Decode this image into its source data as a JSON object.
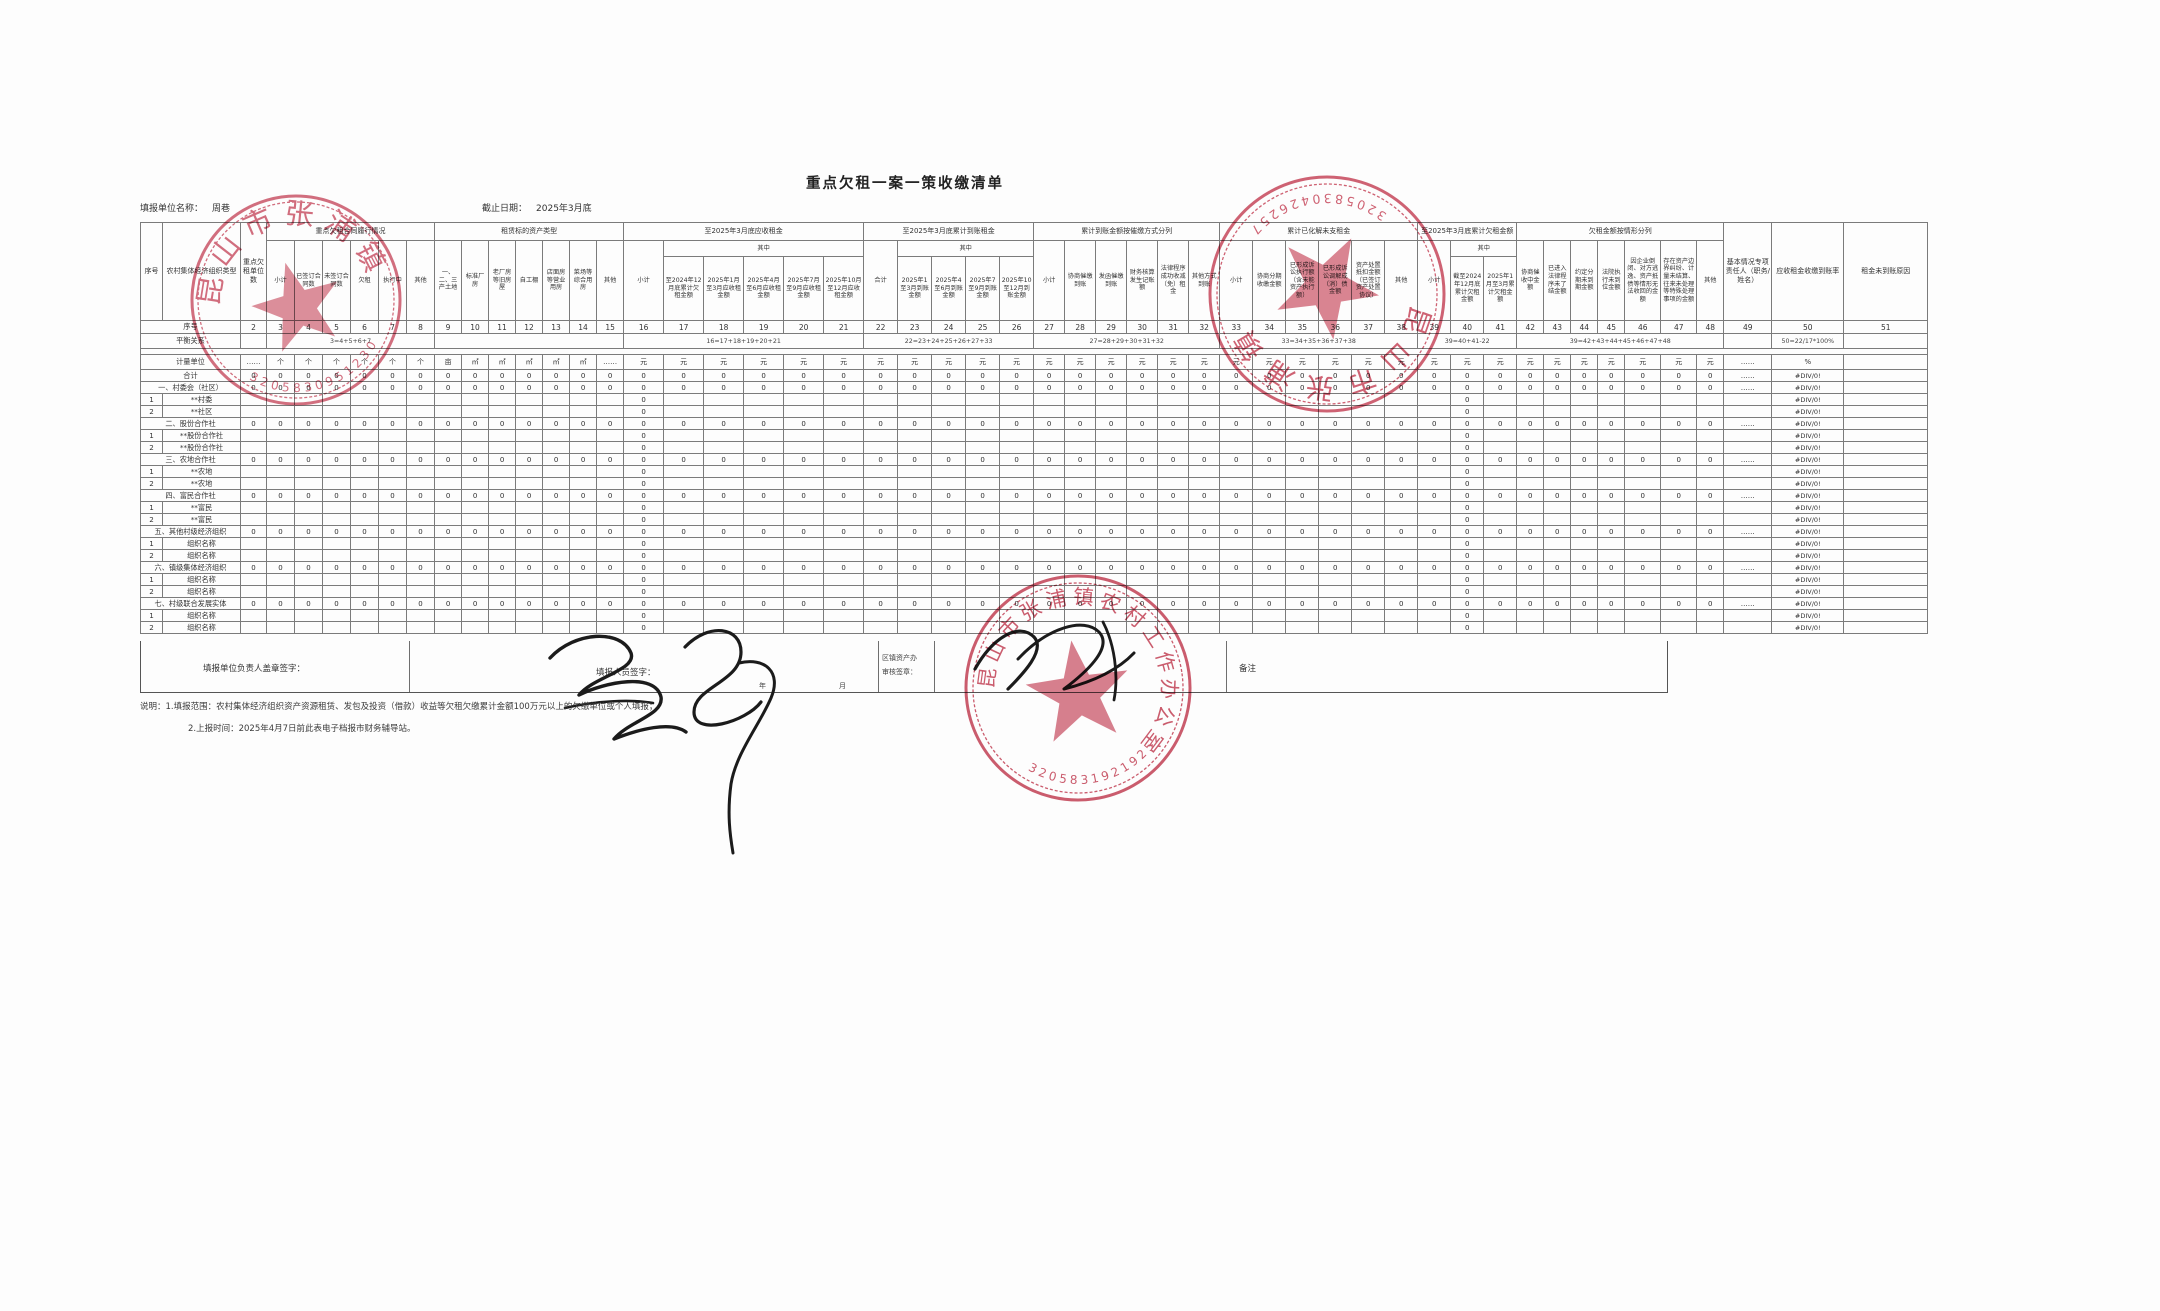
{
  "page": {
    "title": "重点欠租一案一策收缴清单"
  },
  "meta": {
    "unit_label": "填报单位名称：",
    "unit_value": "周巷",
    "date_label": "截止日期：",
    "date_value": "2025年3月底"
  },
  "colors": {
    "stamp_red": "#c64a5e",
    "ink_black": "#1b1b1b",
    "table_line": "#7b7b7b"
  },
  "table": {
    "header_rows": [
      [
        {
          "t": "序号",
          "rs": 3
        },
        {
          "t": "农村集体经济组织类型",
          "rs": 3
        },
        {
          "t": "重点欠租单位数",
          "rs": 3
        },
        {
          "t": "重点欠租合同履行情况",
          "cs": 6
        },
        {
          "t": "租赁标的资产类型",
          "cs": 7
        },
        {
          "t": "至2025年3月底应收租金",
          "cs": 6
        },
        {
          "t": "至2025年3月底累计到账租金",
          "cs": 5
        },
        {
          "t": "累计到账金额按催缴方式分列",
          "cs": 6
        },
        {
          "t": "累计已化解未支租金",
          "cs": 6
        },
        {
          "t": "至2025年3月底累计欠租金额",
          "cs": 3
        },
        {
          "t": "欠租金额按情形分列",
          "cs": 7
        },
        {
          "t": "基本情况专项责任人（职务/姓名）",
          "rs": 3
        },
        {
          "t": "应收租金收缴到账率",
          "rs": 3
        },
        {
          "t": "租金未到账原因",
          "rs": 3
        }
      ],
      [
        {
          "t": "小计",
          "rs": 2
        },
        {
          "t": "已签订合同数",
          "rs": 2
        },
        {
          "t": "未签订合同数",
          "rs": 2
        },
        {
          "t": "欠租",
          "rs": 2
        },
        {
          "t": "执行中",
          "rs": 2
        },
        {
          "t": "其他",
          "rs": 2
        },
        {
          "t": "一、二、三产土地",
          "rs": 2
        },
        {
          "t": "标准厂房",
          "rs": 2
        },
        {
          "t": "老厂房等旧房屋",
          "rs": 2
        },
        {
          "t": "自工棚",
          "rs": 2
        },
        {
          "t": "店面房等营业用房",
          "rs": 2
        },
        {
          "t": "菜场等综合用房",
          "rs": 2
        },
        {
          "t": "其他",
          "rs": 2
        },
        {
          "t": "小计",
          "rs": 2
        },
        {
          "t": "其中",
          "cs": 5
        },
        {
          "t": "合计",
          "rs": 2
        },
        {
          "t": "其中",
          "cs": 4
        },
        {
          "t": "小计",
          "rs": 2
        },
        {
          "t": "协商催缴到账",
          "rs": 2
        },
        {
          "t": "发函催缴到账",
          "rs": 2
        },
        {
          "t": "财务核算发生记账额",
          "rs": 2
        },
        {
          "t": "法律程序成功收减（免）租金",
          "rs": 2
        },
        {
          "t": "其他方式到账",
          "rs": 2
        },
        {
          "t": "小计",
          "rs": 2
        },
        {
          "t": "协商分期收缴金额",
          "rs": 2
        },
        {
          "t": "已形成诉讼执行额（含未能资产执行额）",
          "rs": 2
        },
        {
          "t": "已形成诉讼调解成（消）债金额",
          "rs": 2
        },
        {
          "t": "资产处置抵扣金额（已签订资产处置协议）",
          "rs": 2
        },
        {
          "t": "其他",
          "rs": 2
        },
        {
          "t": "小计",
          "rs": 2
        },
        {
          "t": "其中",
          "cs": 2
        },
        {
          "t": "协商催收中金额",
          "rs": 2
        },
        {
          "t": "已进入法律程序未了结金额",
          "rs": 2
        },
        {
          "t": "约定分期未到期金额",
          "rs": 2
        },
        {
          "t": "法院执行未到位金额",
          "rs": 2
        },
        {
          "t": "因企业倒闭、对方逃逸、资产抵债等情形无法收回的金额",
          "rs": 2
        },
        {
          "t": "存在资产边界纠纷、计量未结算、往来未处理等特殊处理事项的金额",
          "rs": 2
        },
        {
          "t": "其他",
          "rs": 2
        }
      ],
      [
        {
          "t": "至2024年12月底累计欠租金额"
        },
        {
          "t": "2025年1月至3月应收租金额"
        },
        {
          "t": "2025年4月至6月应收租金额"
        },
        {
          "t": "2025年7月至9月应收租金额"
        },
        {
          "t": "2025年10月至12月应收租金额"
        },
        {
          "t": "2025年1至3月到账金额"
        },
        {
          "t": "2025年4至6月到账金额"
        },
        {
          "t": "2025年7至9月到账金额"
        },
        {
          "t": "2025年10至12月到账金额"
        },
        {
          "t": "截至2024年12月底累计欠租金额"
        },
        {
          "t": "2025年1月至3月累计欠租金额"
        }
      ]
    ],
    "numbering_label": "序号",
    "numbering": [
      "2",
      "3",
      "4",
      "5",
      "6",
      "7",
      "8",
      "9",
      "10",
      "11",
      "12",
      "13",
      "14",
      "15",
      "16",
      "17",
      "18",
      "19",
      "20",
      "21",
      "22",
      "23",
      "24",
      "25",
      "26",
      "27",
      "28",
      "29",
      "30",
      "31",
      "32",
      "33",
      "34",
      "35",
      "36",
      "37",
      "38",
      "39",
      "40",
      "41",
      "42",
      "43",
      "44",
      "45",
      "46",
      "47",
      "48",
      "49",
      "50",
      "51"
    ],
    "balance_label": "平衡关系",
    "balance": [
      {
        "t": "",
        "cs": 1
      },
      {
        "t": "3=4+5+6+7",
        "cs": 6
      },
      {
        "t": "",
        "cs": 7
      },
      {
        "t": "16=17+18+19+20+21",
        "cs": 6
      },
      {
        "t": "22=23+24+25+26+27+33",
        "cs": 5
      },
      {
        "t": "27=28+29+30+31+32",
        "cs": 6
      },
      {
        "t": "33=34+35+36+37+38",
        "cs": 6
      },
      {
        "t": "39=40+41-22",
        "cs": 3
      },
      {
        "t": "39=42+43+44+45+46+47+48",
        "cs": 7
      },
      {
        "t": "",
        "cs": 1
      },
      {
        "t": "50=22/17*100%",
        "cs": 1
      },
      {
        "t": "",
        "cs": 1
      }
    ],
    "units_label": "计量单位",
    "units": [
      "……",
      "个",
      "个",
      "个",
      "个",
      "个",
      "个",
      "亩",
      "㎡",
      "㎡",
      "㎡",
      "㎡",
      "㎡",
      "……",
      "元",
      "元",
      "元",
      "元",
      "元",
      "元",
      "元",
      "元",
      "元",
      "元",
      "元",
      "元",
      "元",
      "元",
      "元",
      "元",
      "元",
      "元",
      "元",
      "元",
      "元",
      "元",
      "元",
      "元",
      "元",
      "元",
      "元",
      "元",
      "元",
      "元",
      "元",
      "元",
      "元",
      "……",
      "%",
      ""
    ],
    "cell_values": {
      "zero": "0",
      "dots": "……",
      "div0": "#DIV/0!"
    },
    "rows": [
      {
        "label": "合计",
        "type": "full"
      },
      {
        "label": "一、村委会（社区）",
        "type": "full"
      },
      {
        "num": "1",
        "label": "**村委",
        "type": "sub"
      },
      {
        "num": "2",
        "label": "**社区",
        "type": "sub"
      },
      {
        "label": "二、股份合作社",
        "type": "full"
      },
      {
        "num": "1",
        "label": "**股份合作社",
        "type": "sub"
      },
      {
        "num": "2",
        "label": "**股份合作社",
        "type": "sub"
      },
      {
        "label": "三、农地合作社",
        "type": "full"
      },
      {
        "num": "1",
        "label": "**农地",
        "type": "sub"
      },
      {
        "num": "2",
        "label": "**农地",
        "type": "sub"
      },
      {
        "label": "四、富民合作社",
        "type": "full"
      },
      {
        "num": "1",
        "label": "**富民",
        "type": "sub"
      },
      {
        "num": "2",
        "label": "**富民",
        "type": "sub"
      },
      {
        "label": "五、其他村级经济组织",
        "type": "full"
      },
      {
        "num": "1",
        "label": "组织名称",
        "type": "sub"
      },
      {
        "num": "2",
        "label": "组织名称",
        "type": "sub"
      },
      {
        "label": "六、镇级集体经济组织",
        "type": "full"
      },
      {
        "num": "1",
        "label": "组织名称",
        "type": "sub"
      },
      {
        "num": "2",
        "label": "组织名称",
        "type": "sub"
      },
      {
        "label": "七、村级联合发展实体",
        "type": "full"
      },
      {
        "num": "1",
        "label": "组织名称",
        "type": "sub"
      },
      {
        "num": "2",
        "label": "组织名称",
        "type": "sub"
      }
    ]
  },
  "signature": {
    "leader_label": "填报单位负责人盖章签字：",
    "filler_label": "填报人员签字：",
    "review_label_line1": "区镇资产办",
    "review_label_line2": "审核签章：",
    "remark_label": "备注",
    "year_label": "年",
    "month_label": "月"
  },
  "notes": [
    "说明：1.填报范围：农村集体经济组织资产资源租赁、发包及投资（借款）收益等欠租欠缴累计金额100万元以上的欠缴单位或个人填报；",
    "2.上报时间：2025年4月7日前此表电子档报市财务辅导站。"
  ],
  "stamps": [
    {
      "position": "top-left",
      "org": "昆山市张浦镇",
      "code": "3205830951230"
    },
    {
      "position": "top-right",
      "org": "昆山市张浦镇",
      "code": "3205830426257"
    },
    {
      "position": "bottom-center",
      "org": "昆山市张浦镇农村工作办公室",
      "code": "3205831921925"
    }
  ]
}
